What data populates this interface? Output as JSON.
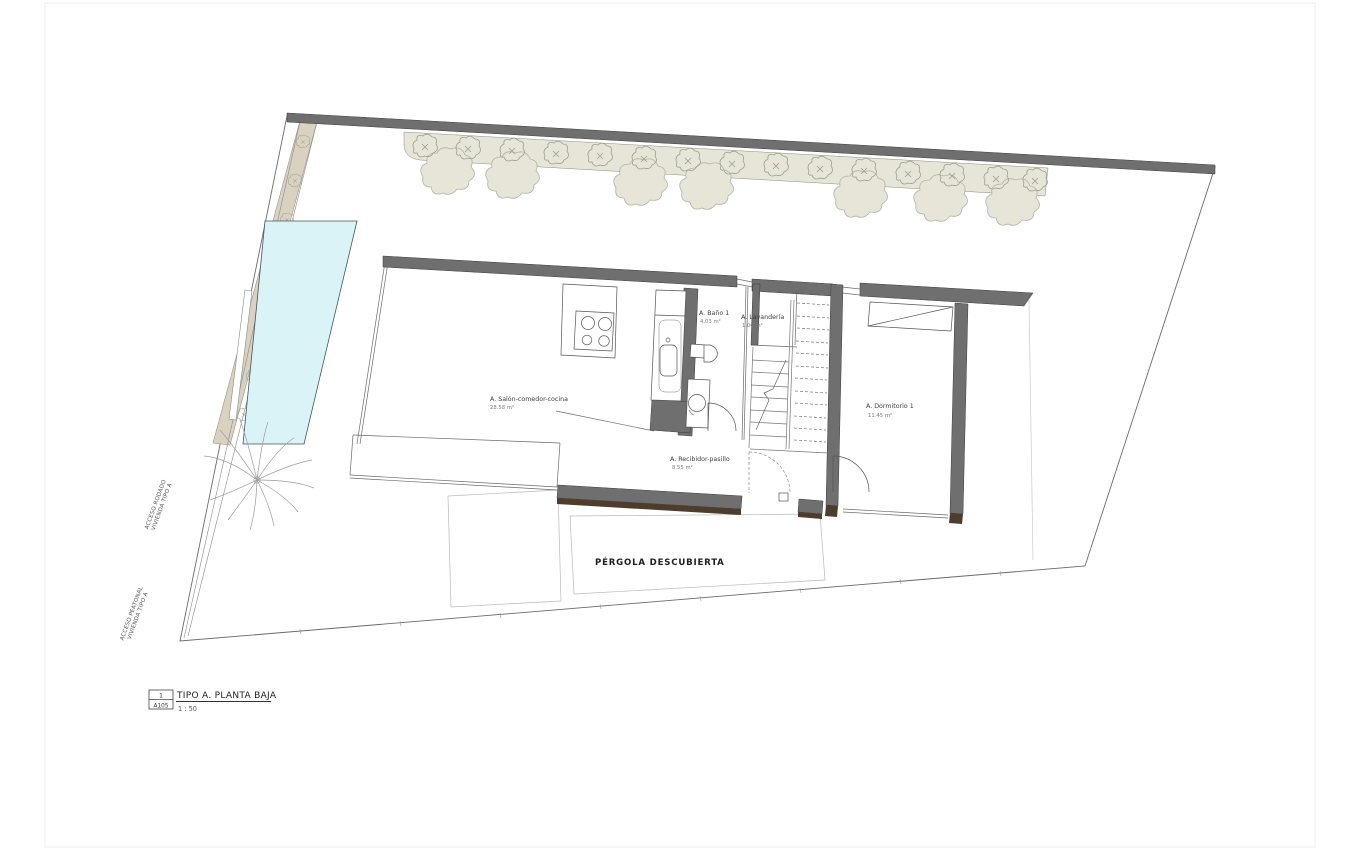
{
  "drawing": {
    "rooms": {
      "salon": {
        "name": "A. Salón-comedor-cocina",
        "area": "28.58 m²"
      },
      "bano": {
        "name": "A. Baño 1",
        "area": "4.03 m²"
      },
      "lavanderia": {
        "name": "A. Lavandería",
        "area": "1.06 m²"
      },
      "dormitorio": {
        "name": "A. Dormitorio 1",
        "area": "11.45 m²"
      },
      "recibidor": {
        "name": "A. Recibidor-pasillo",
        "area": "8.55 m²"
      }
    },
    "outdoor": {
      "pergola_label": "PÉRGOLA DESCUBIERTA"
    },
    "site_labels": {
      "acceso_rodado_line1": "ACCESO RODADO",
      "acceso_rodado_line2": "VIVIENDA TIPO A",
      "acceso_peatonal_line1": "ACCESO PEATONAL",
      "acceso_peatonal_line2": "VIVIENDA TIPO A"
    },
    "title_block": {
      "detail_number": "1",
      "sheet_code": "A105",
      "title": "TIPO A. PLANTA BAJA",
      "scale": "1 : 50"
    },
    "colors": {
      "wall_gray": "#6f6f6f",
      "wall_edge": "#3d3d3d",
      "wood_brown": "#4e3d2c",
      "pool_cyan": "#d9f3f7",
      "planter_beige": "#e7e4d8",
      "driveway_tan": "#d9d2c1",
      "line_dark": "#555555",
      "vegetation_stroke": "#9aa18d"
    }
  }
}
